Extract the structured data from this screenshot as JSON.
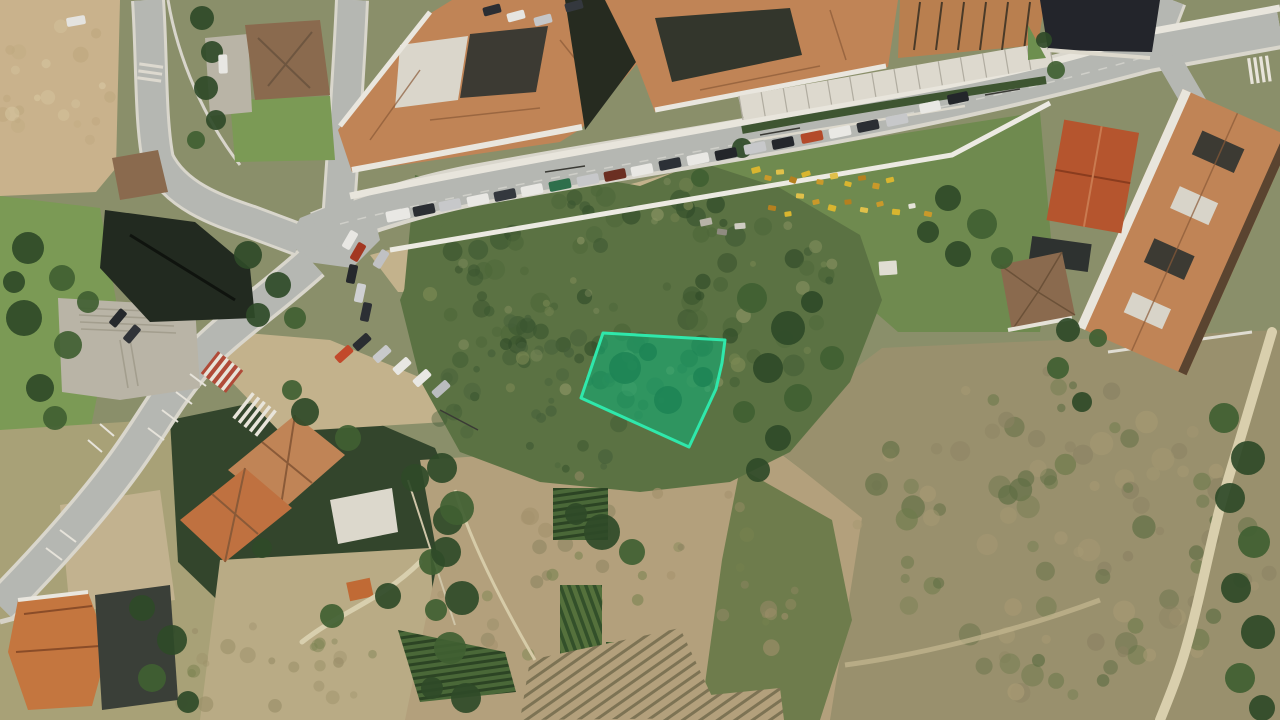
{
  "map": {
    "kind": "satellite-aerial-view",
    "overlay": "highlighted-land-parcel"
  },
  "palette": {
    "base": "#8a8f6a",
    "road": "#b5b7b2",
    "roadEdge": "#d9d6cc",
    "sidewalk": "#e8e5dc",
    "plaza": "#b9b4a6",
    "dirt": "#c9b28c",
    "dirtLight": "#d7c7a4",
    "shoulder": "#c3b28c",
    "scrub": "#5b7243",
    "scrubDark": "#3a5530",
    "treeDark": "#2f4a28",
    "treeMid": "#406032",
    "lawn": "#7b9a55",
    "gardenGreen": "#6f8a4f",
    "field": "#99906d",
    "gardensDirt": "#b3a07c",
    "pathTan": "#d9cfad",
    "roof": "#c08456",
    "roofRidge": "#8a5a38",
    "roofBright": "#b5552e",
    "roofBrown": "#8a6a4e",
    "darkRoof": "#23252b",
    "darkBuilding": "#222a20",
    "alley": "#262b20",
    "white": "#e9e6de",
    "courtDark": "#3c3a33",
    "crossRed": "#b04a38",
    "crossWhite": "#e8e4da"
  },
  "parcel": {
    "points": "603,333 725,340 722,363 716,389 689,447 581,398",
    "fill": "#0fae76",
    "fill_opacity": "0.58",
    "stroke": "#2fe8ab",
    "stroke_width": "3"
  },
  "cars": {
    "main_road_parked": [
      {
        "x": 398,
        "y": 215,
        "c": "#e9e8e4",
        "w": 24,
        "h": 11
      },
      {
        "x": 424,
        "y": 210,
        "c": "#2b2e33"
      },
      {
        "x": 450,
        "y": 205,
        "c": "#c7c8ca"
      },
      {
        "x": 478,
        "y": 200,
        "c": "#e9e8e4"
      },
      {
        "x": 505,
        "y": 195,
        "c": "#34383e"
      },
      {
        "x": 532,
        "y": 190,
        "c": "#e9e8e4"
      },
      {
        "x": 560,
        "y": 185,
        "c": "#2e6f4b"
      },
      {
        "x": 588,
        "y": 180,
        "c": "#c7c8ca"
      },
      {
        "x": 615,
        "y": 175,
        "c": "#6b2f22"
      },
      {
        "x": 642,
        "y": 170,
        "c": "#e9e8e4"
      },
      {
        "x": 670,
        "y": 164,
        "c": "#2c3036"
      },
      {
        "x": 698,
        "y": 159,
        "c": "#e9e8e4"
      },
      {
        "x": 726,
        "y": 154,
        "c": "#23262a"
      },
      {
        "x": 755,
        "y": 148,
        "c": "#c7c8ca"
      },
      {
        "x": 783,
        "y": 143,
        "c": "#24272c"
      },
      {
        "x": 812,
        "y": 137,
        "c": "#b34a2a"
      },
      {
        "x": 840,
        "y": 132,
        "c": "#e9e8e4"
      },
      {
        "x": 868,
        "y": 126,
        "c": "#2b2e33"
      },
      {
        "x": 897,
        "y": 120,
        "c": "#c7c8ca"
      }
    ],
    "on_road": [
      {
        "x": 930,
        "y": 107,
        "a": -12,
        "c": "#e9e8e4"
      },
      {
        "x": 958,
        "y": 98,
        "a": -12,
        "c": "#23262a"
      }
    ],
    "courtyard": [
      {
        "x": 492,
        "y": 10,
        "a": -15,
        "c": "#2b2e33",
        "w": 18,
        "h": 9
      },
      {
        "x": 516,
        "y": 16,
        "a": -15,
        "c": "#e6e5e1",
        "w": 18,
        "h": 9
      },
      {
        "x": 543,
        "y": 20,
        "a": -15,
        "c": "#c5c6c8",
        "w": 18,
        "h": 9
      },
      {
        "x": 574,
        "y": 6,
        "a": -15,
        "c": "#34383e",
        "w": 18,
        "h": 9
      }
    ],
    "parking_area": [
      {
        "x": 350,
        "y": 240,
        "a": -60,
        "c": "#e8e7e3"
      },
      {
        "x": 358,
        "y": 252,
        "a": -60,
        "c": "#a33822"
      },
      {
        "x": 381,
        "y": 259,
        "a": -58,
        "c": "#c0c1c3"
      },
      {
        "x": 352,
        "y": 274,
        "a": -78,
        "c": "#25282c"
      },
      {
        "x": 360,
        "y": 293,
        "a": -78,
        "c": "#cfd0d2"
      },
      {
        "x": 366,
        "y": 312,
        "a": -78,
        "c": "#2c2f34"
      },
      {
        "x": 344,
        "y": 354,
        "a": -42,
        "c": "#c2492b"
      },
      {
        "x": 362,
        "y": 342,
        "a": -42,
        "c": "#2a2d31"
      },
      {
        "x": 382,
        "y": 354,
        "a": -42,
        "c": "#c8c9cb"
      },
      {
        "x": 402,
        "y": 366,
        "a": -42,
        "c": "#e8e7e3"
      },
      {
        "x": 422,
        "y": 378,
        "a": -42,
        "c": "#e8e7e3"
      },
      {
        "x": 441,
        "y": 389,
        "a": -42,
        "c": "#babcbe"
      },
      {
        "x": 118,
        "y": 318,
        "a": -50,
        "c": "#26292d"
      },
      {
        "x": 132,
        "y": 334,
        "a": -50,
        "c": "#303338"
      },
      {
        "x": 223,
        "y": 64,
        "a": 88,
        "c": "#e8e7e3"
      },
      {
        "x": 76,
        "y": 21,
        "a": -10,
        "c": "#e4e3df"
      }
    ]
  },
  "trees": [
    {
      "x": 28,
      "y": 248,
      "r": 16
    },
    {
      "x": 62,
      "y": 278,
      "r": 13,
      "t": 1
    },
    {
      "x": 24,
      "y": 318,
      "r": 18
    },
    {
      "x": 68,
      "y": 345,
      "r": 14,
      "t": 1
    },
    {
      "x": 40,
      "y": 388,
      "r": 14
    },
    {
      "x": 88,
      "y": 302,
      "r": 11,
      "t": 1
    },
    {
      "x": 14,
      "y": 282,
      "r": 11
    },
    {
      "x": 55,
      "y": 418,
      "r": 12,
      "t": 1
    },
    {
      "x": 202,
      "y": 18,
      "r": 12
    },
    {
      "x": 212,
      "y": 52,
      "r": 11
    },
    {
      "x": 206,
      "y": 88,
      "r": 12
    },
    {
      "x": 216,
      "y": 120,
      "r": 10
    },
    {
      "x": 196,
      "y": 140,
      "r": 9,
      "t": 1
    },
    {
      "x": 248,
      "y": 255,
      "r": 14
    },
    {
      "x": 278,
      "y": 285,
      "r": 13
    },
    {
      "x": 258,
      "y": 315,
      "r": 12
    },
    {
      "x": 295,
      "y": 318,
      "r": 11,
      "t": 1
    },
    {
      "x": 305,
      "y": 412,
      "r": 14
    },
    {
      "x": 348,
      "y": 438,
      "r": 13,
      "t": 1
    },
    {
      "x": 415,
      "y": 478,
      "r": 14
    },
    {
      "x": 448,
      "y": 520,
      "r": 15
    },
    {
      "x": 432,
      "y": 562,
      "r": 13,
      "t": 1
    },
    {
      "x": 388,
      "y": 596,
      "r": 13
    },
    {
      "x": 332,
      "y": 616,
      "r": 12,
      "t": 1
    },
    {
      "x": 262,
      "y": 548,
      "r": 10
    },
    {
      "x": 292,
      "y": 390,
      "r": 10,
      "t": 1
    },
    {
      "x": 442,
      "y": 468,
      "r": 15
    },
    {
      "x": 457,
      "y": 508,
      "r": 17,
      "t": 1
    },
    {
      "x": 446,
      "y": 552,
      "r": 15
    },
    {
      "x": 462,
      "y": 598,
      "r": 17
    },
    {
      "x": 450,
      "y": 648,
      "r": 16,
      "t": 1
    },
    {
      "x": 466,
      "y": 698,
      "r": 15
    },
    {
      "x": 432,
      "y": 688,
      "r": 11
    },
    {
      "x": 436,
      "y": 610,
      "r": 11,
      "t": 1
    },
    {
      "x": 752,
      "y": 298,
      "r": 15,
      "t": 1
    },
    {
      "x": 788,
      "y": 328,
      "r": 17
    },
    {
      "x": 768,
      "y": 368,
      "r": 15
    },
    {
      "x": 798,
      "y": 398,
      "r": 14,
      "t": 1
    },
    {
      "x": 778,
      "y": 438,
      "r": 13
    },
    {
      "x": 744,
      "y": 412,
      "r": 11,
      "t": 1
    },
    {
      "x": 812,
      "y": 302,
      "r": 11
    },
    {
      "x": 832,
      "y": 358,
      "r": 12,
      "t": 1
    },
    {
      "x": 758,
      "y": 470,
      "r": 12
    },
    {
      "x": 948,
      "y": 198,
      "r": 13
    },
    {
      "x": 982,
      "y": 224,
      "r": 15,
      "t": 1
    },
    {
      "x": 958,
      "y": 254,
      "r": 13
    },
    {
      "x": 1002,
      "y": 258,
      "r": 11,
      "t": 1
    },
    {
      "x": 928,
      "y": 232,
      "r": 11
    },
    {
      "x": 1068,
      "y": 330,
      "r": 12
    },
    {
      "x": 1058,
      "y": 368,
      "r": 11,
      "t": 1
    },
    {
      "x": 1082,
      "y": 402,
      "r": 10
    },
    {
      "x": 1098,
      "y": 338,
      "r": 9,
      "t": 1
    },
    {
      "x": 1224,
      "y": 418,
      "r": 15,
      "t": 1
    },
    {
      "x": 1248,
      "y": 458,
      "r": 17
    },
    {
      "x": 1230,
      "y": 498,
      "r": 15
    },
    {
      "x": 1254,
      "y": 542,
      "r": 16,
      "t": 1
    },
    {
      "x": 1236,
      "y": 588,
      "r": 15
    },
    {
      "x": 1258,
      "y": 632,
      "r": 17
    },
    {
      "x": 1240,
      "y": 678,
      "r": 15,
      "t": 1
    },
    {
      "x": 1262,
      "y": 708,
      "r": 13
    },
    {
      "x": 142,
      "y": 608,
      "r": 13
    },
    {
      "x": 172,
      "y": 640,
      "r": 15
    },
    {
      "x": 152,
      "y": 678,
      "r": 14,
      "t": 1
    },
    {
      "x": 188,
      "y": 702,
      "r": 11
    },
    {
      "x": 602,
      "y": 532,
      "r": 18
    },
    {
      "x": 632,
      "y": 552,
      "r": 13,
      "t": 1
    },
    {
      "x": 576,
      "y": 514,
      "r": 11
    },
    {
      "x": 742,
      "y": 148,
      "r": 10
    },
    {
      "x": 700,
      "y": 178,
      "r": 9,
      "t": 1
    },
    {
      "x": 1056,
      "y": 70,
      "r": 9,
      "t": 1
    },
    {
      "x": 1044,
      "y": 40,
      "r": 8
    }
  ],
  "debris_yard": [
    {
      "x": 756,
      "y": 170,
      "w": 9,
      "h": 6,
      "a": -15,
      "c": "#d9b52f"
    },
    {
      "x": 768,
      "y": 178,
      "w": 7,
      "h": 5,
      "a": 12,
      "c": "#c9992a"
    },
    {
      "x": 780,
      "y": 172,
      "w": 8,
      "h": 5,
      "a": -5,
      "c": "#e0c04a"
    },
    {
      "x": 793,
      "y": 180,
      "w": 7,
      "h": 6,
      "a": 20,
      "c": "#b5801f"
    },
    {
      "x": 806,
      "y": 174,
      "w": 9,
      "h": 5,
      "a": -18,
      "c": "#d9b52f"
    },
    {
      "x": 820,
      "y": 182,
      "w": 7,
      "h": 5,
      "a": 8,
      "c": "#c9992a"
    },
    {
      "x": 834,
      "y": 176,
      "w": 8,
      "h": 6,
      "a": -10,
      "c": "#e0c04a"
    },
    {
      "x": 848,
      "y": 184,
      "w": 7,
      "h": 5,
      "a": 15,
      "c": "#d9b52f"
    },
    {
      "x": 862,
      "y": 178,
      "w": 8,
      "h": 5,
      "a": -8,
      "c": "#b5801f"
    },
    {
      "x": 876,
      "y": 186,
      "w": 7,
      "h": 6,
      "a": 10,
      "c": "#c9992a"
    },
    {
      "x": 890,
      "y": 180,
      "w": 8,
      "h": 5,
      "a": -14,
      "c": "#d9b52f"
    },
    {
      "x": 800,
      "y": 196,
      "w": 8,
      "h": 5,
      "a": 5,
      "c": "#e0c04a"
    },
    {
      "x": 816,
      "y": 202,
      "w": 7,
      "h": 5,
      "a": -12,
      "c": "#c9992a"
    },
    {
      "x": 832,
      "y": 208,
      "w": 8,
      "h": 6,
      "a": 14,
      "c": "#d9b52f"
    },
    {
      "x": 848,
      "y": 202,
      "w": 7,
      "h": 5,
      "a": -6,
      "c": "#b5801f"
    },
    {
      "x": 864,
      "y": 210,
      "w": 8,
      "h": 5,
      "a": 10,
      "c": "#e0c04a"
    },
    {
      "x": 880,
      "y": 204,
      "w": 7,
      "h": 5,
      "a": -15,
      "c": "#c9992a"
    },
    {
      "x": 896,
      "y": 212,
      "w": 8,
      "h": 6,
      "a": 6,
      "c": "#d9b52f"
    },
    {
      "x": 912,
      "y": 206,
      "w": 7,
      "h": 5,
      "a": -10,
      "c": "#e6e3da"
    },
    {
      "x": 928,
      "y": 214,
      "w": 8,
      "h": 5,
      "a": 12,
      "c": "#c9992a"
    },
    {
      "x": 788,
      "y": 214,
      "w": 7,
      "h": 5,
      "a": -8,
      "c": "#d9b52f"
    },
    {
      "x": 772,
      "y": 208,
      "w": 8,
      "h": 5,
      "a": 10,
      "c": "#b5801f"
    },
    {
      "x": 706,
      "y": 222,
      "w": 12,
      "h": 7,
      "a": -12,
      "c": "#b8b4a8"
    },
    {
      "x": 722,
      "y": 232,
      "w": 10,
      "h": 6,
      "a": 8,
      "c": "#8f8b80"
    },
    {
      "x": 740,
      "y": 226,
      "w": 11,
      "h": 6,
      "a": -5,
      "c": "#cfccc2"
    },
    {
      "x": 888,
      "y": 268,
      "w": 18,
      "h": 14,
      "a": -4,
      "c": "#e0ddd2"
    }
  ]
}
